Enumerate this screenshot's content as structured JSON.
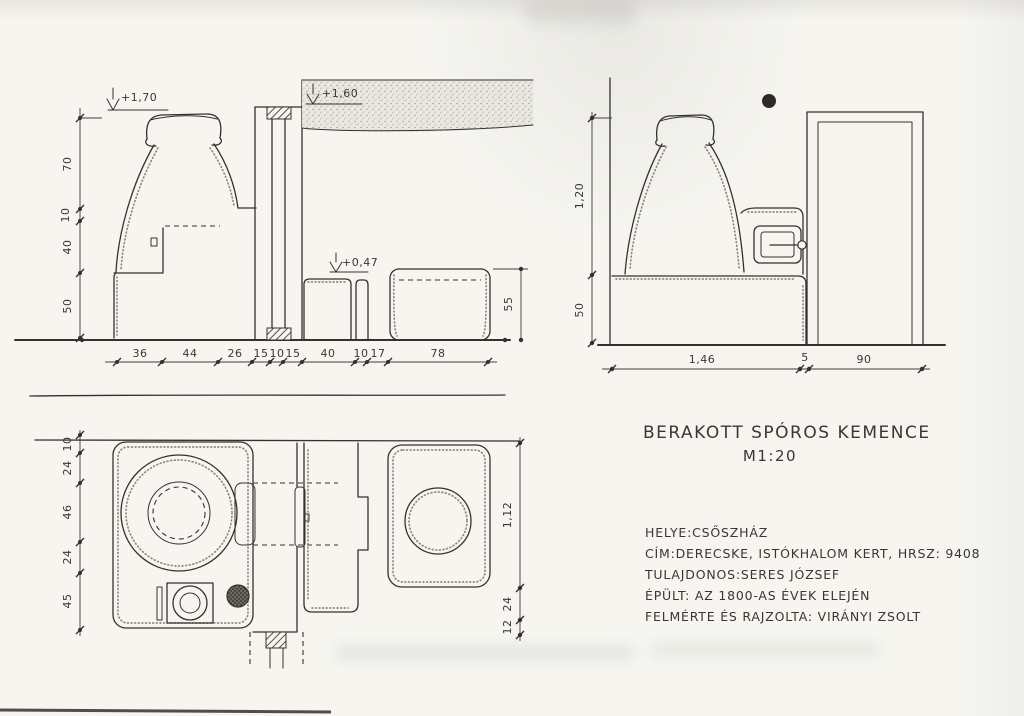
{
  "paper": {
    "background": "#f6f5f0",
    "ink": "#35322e"
  },
  "title_block": {
    "title": "BERAKOTT SPÓROS KEMENCE",
    "scale": "M1:20"
  },
  "info_block": {
    "lines": [
      "HELYE:CSŐSZHÁZ",
      "CÍM:DERECSKE, ISTÓKHALOM KERT, HRSZ: 9408",
      "TULAJDONOS:SERES JÓZSEF",
      "ÉPÜLT: AZ 1800-AS ÉVEK ELEJÉN",
      "FELMÉRTE ÉS RAJZOLTA: VIRÁNYI ZSOLT"
    ]
  },
  "front_elevation": {
    "level_top_left": "+1,70",
    "level_top_right": "+1,60",
    "level_bench": "+0,47",
    "dims_left": [
      "70",
      "10",
      "40",
      "50"
    ],
    "dims_bottom": [
      "36",
      "44",
      "26",
      "15",
      "10",
      "15",
      "40",
      "10",
      "17",
      "78"
    ],
    "dim_right": "55"
  },
  "side_elevation": {
    "dims_left": [
      "1,20",
      "50"
    ],
    "dims_bottom": [
      "1,46",
      "5",
      "90"
    ]
  },
  "plan_view": {
    "dims_left": [
      "10",
      "24",
      "46",
      "24",
      "45"
    ],
    "dims_right": [
      "1,12",
      "24",
      "12"
    ]
  }
}
